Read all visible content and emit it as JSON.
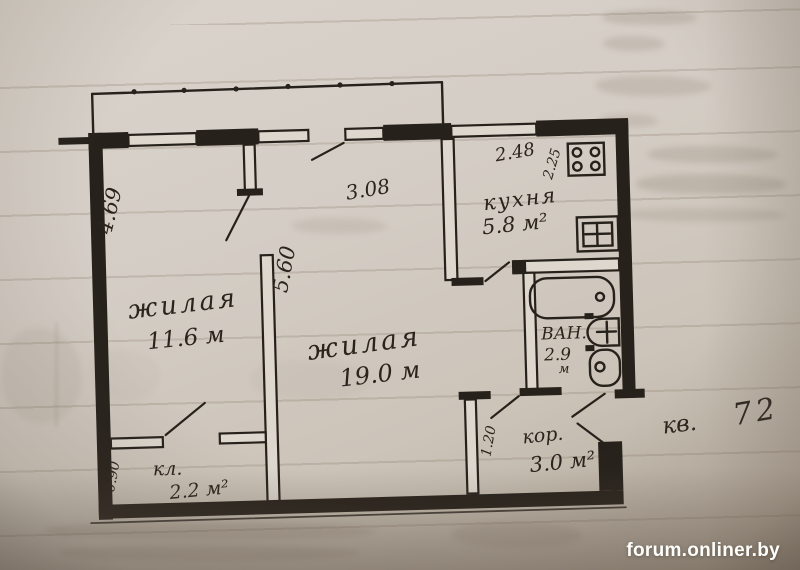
{
  "watermark": {
    "text": "forum.onliner.by"
  },
  "plan": {
    "apartment": {
      "label": "кв.",
      "number": "72"
    },
    "rooms": {
      "room1": {
        "name": "жилая",
        "area": "11.6 м"
      },
      "room2": {
        "name": "жилая",
        "area": "19.0 м"
      },
      "kitchen": {
        "name": "кухня",
        "area": "5.8 м²"
      },
      "bath": {
        "name": "ВАН.",
        "area": "2.9",
        "unit": "м"
      },
      "corridor": {
        "name": "кор.",
        "area": "3.0 м²"
      },
      "closet": {
        "name": "кл.",
        "area": "2.2 м²"
      }
    },
    "dimensions": {
      "room1_side": "4.69",
      "room2_top": "3.08",
      "depth": "5.60",
      "kitchen_width": "2.48",
      "kitchen_side": "2.25",
      "closet_side": "0.90",
      "corridor_side": "1.20"
    },
    "fixtures": [
      "balcony-railing",
      "stove",
      "sink",
      "bathtub",
      "washbasin",
      "toilet"
    ],
    "colors": {
      "ink": "#26211b",
      "paper": "#d4cdc5",
      "paper_dark": "#948879",
      "watermark": "#fdfdfb"
    }
  }
}
